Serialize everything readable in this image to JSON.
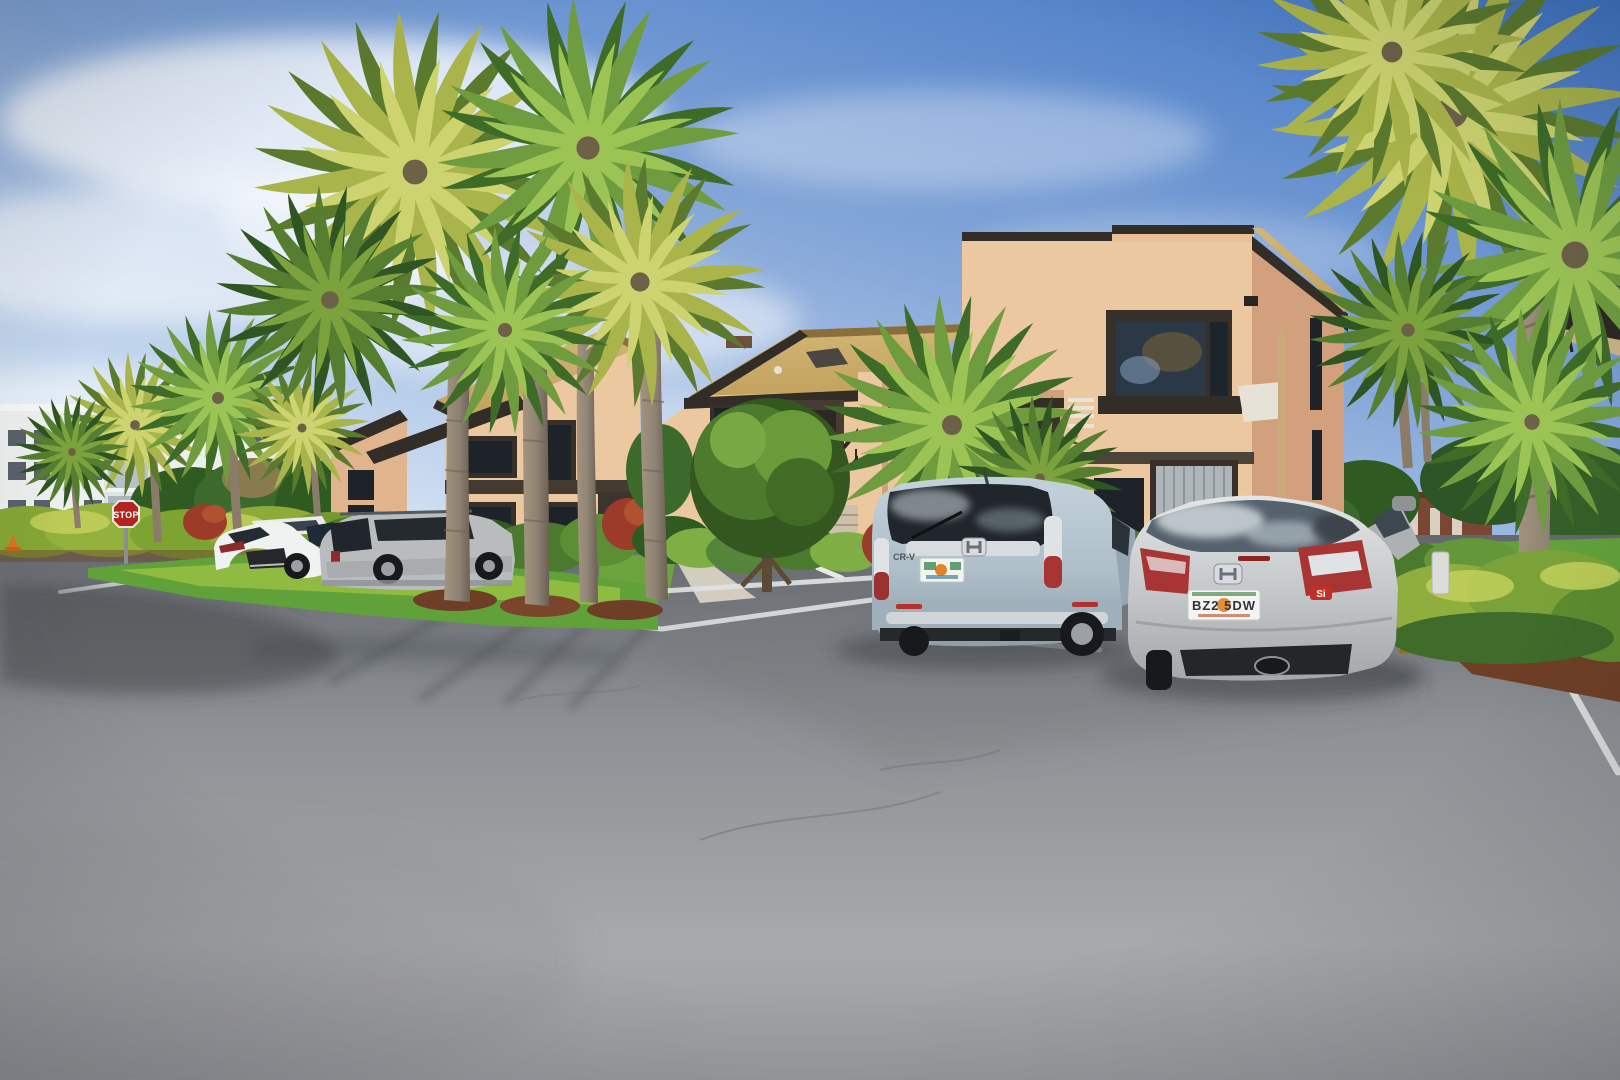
{
  "scene": {
    "description": "Sunny two-story peach stucco condominium complex with palm trees, hedges and cars parked in an asphalt parking lot"
  },
  "signs": {
    "stop_sign_label": "STOP"
  },
  "vehicles": {
    "civic": {
      "license_plate": "BZ2 5DW",
      "trim_badge": "Si"
    },
    "crv": {
      "model_badge": "CR-V"
    }
  },
  "colors": {
    "sky_top": "#3f74c4",
    "sky_mid": "#85a7d8",
    "sky_horizon": "#dce9f6",
    "white_building": "#edefee",
    "stucco_light": "#ecc8a0",
    "stucco_mid": "#e0b48d",
    "stucco_shade": "#d2a07d",
    "roof_shingle": "#c2a25e",
    "trim_dark": "#332d27",
    "asphalt_light": "#a7a9ab",
    "asphalt_dark": "#64686c",
    "line_white": "#dfe2e2",
    "curb_yellow": "#d9a622",
    "grass": "#61a13a",
    "grass_bright": "#9ec443",
    "hedge": "#86a635",
    "foliage_dark": "#3f6b2f",
    "mulch": "#6e3f26",
    "trunk": "#8d8273",
    "palm_yellow": "#a9b44a",
    "palm_green": "#6f9c3f",
    "stop_red": "#b02520",
    "walkway": "#d3cdbf",
    "glass_dark": "#20262c",
    "lexus_white": "#f0f1f1",
    "suv_silver": "#b9bcbe",
    "crv_blue": "#aebfca",
    "civic_silver": "#c6c9cb",
    "taillight_red": "#a83434"
  }
}
